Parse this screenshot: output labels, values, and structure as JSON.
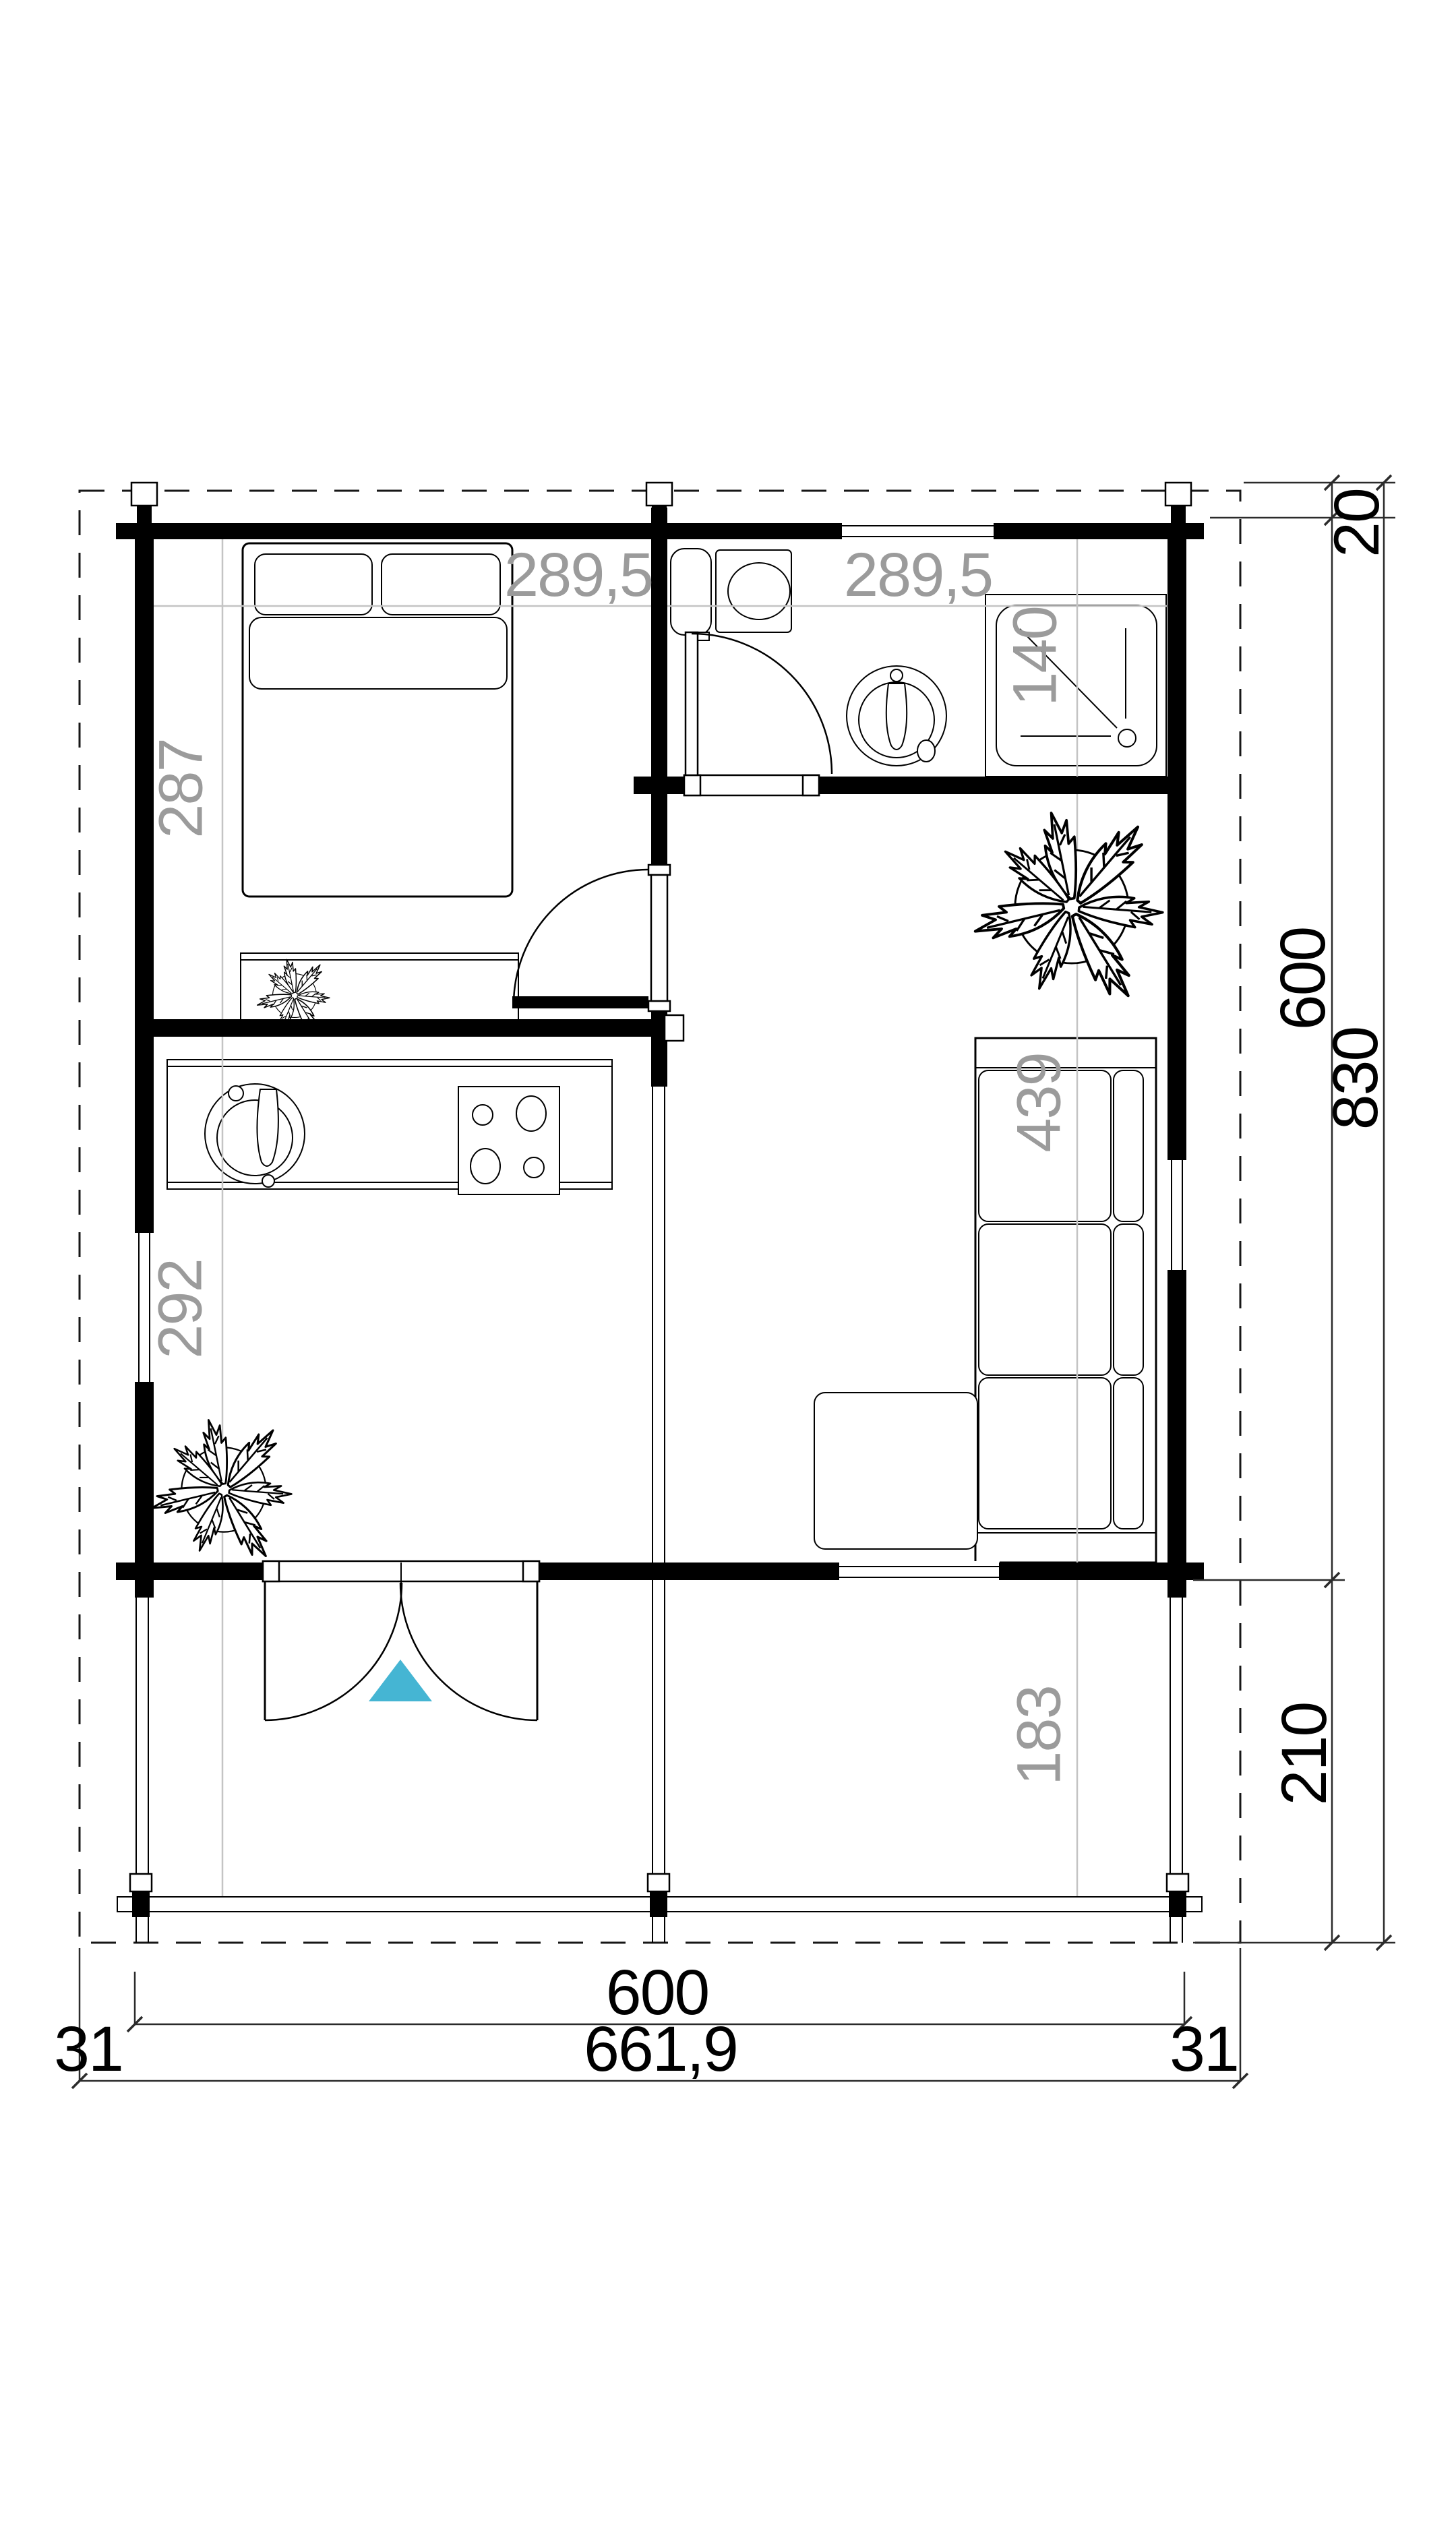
{
  "colors": {
    "accent": "#45b5d3",
    "label_gray": "#9b9b9b"
  },
  "rooms": {
    "bedroom": {
      "width": "289,5",
      "depth": "287"
    },
    "bathroom": {
      "width": "289,5",
      "shower_dim": "140"
    },
    "kitchen": {
      "depth": "292"
    },
    "living": {
      "sofa_length": "439"
    },
    "terrace": {
      "depth": "183"
    }
  },
  "dims": {
    "right": {
      "roof_overhang": "20",
      "building_depth": "600",
      "total_depth": "830",
      "terrace_depth": "210"
    },
    "bottom": {
      "building_width": "600",
      "total_width": "661,9",
      "overhang_left": "31",
      "overhang_right": "31"
    }
  }
}
